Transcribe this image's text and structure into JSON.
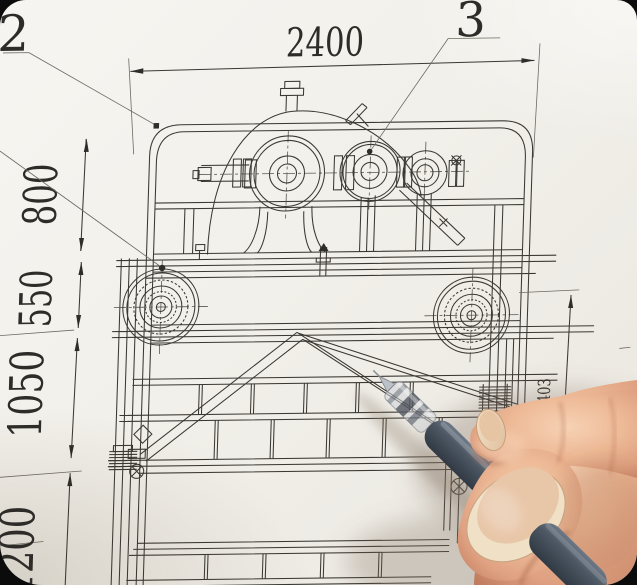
{
  "drawing": {
    "dimensions": {
      "top": "2400",
      "left": [
        "800",
        "550",
        "1050",
        "1200"
      ],
      "right": "1403"
    },
    "callouts": {
      "left": "2",
      "right": "3"
    },
    "colors": {
      "paper": "#f2efe9",
      "ink": "#3b3833"
    }
  },
  "pen": {
    "barrel_color": "#49545f"
  },
  "hand": {
    "skin_color": "#e8ae8c"
  }
}
